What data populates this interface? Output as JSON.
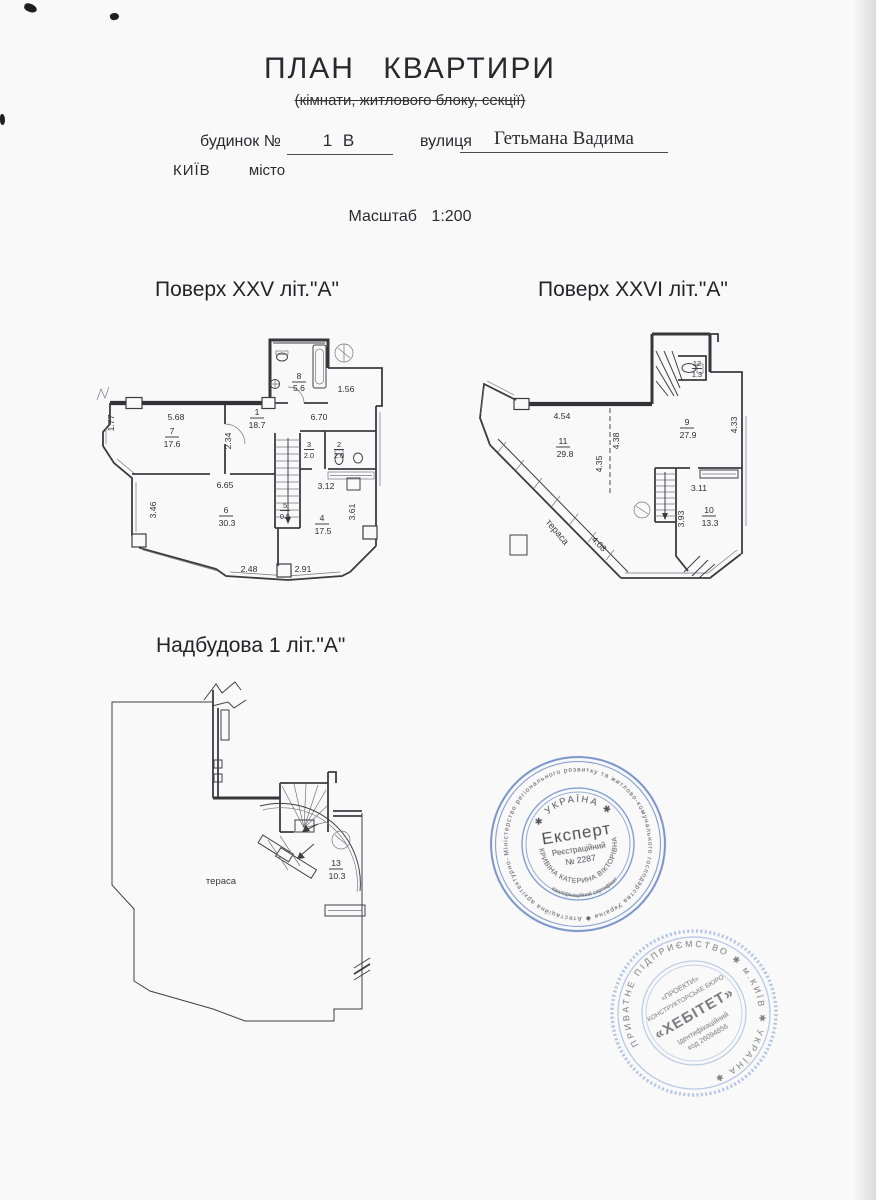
{
  "header": {
    "title": "ПЛАН КВАРТИРИ",
    "subtitle": "(кімнати, житлового блоку, секції)",
    "building_label": "будинок №",
    "building_number": "1 В",
    "street_label": "вулиця",
    "street_name": "Гетьмана Вадима",
    "city_name": "КИЇВ",
    "city_label": "місто",
    "scale_label": "Масштаб",
    "scale_value": "1:200"
  },
  "plan_xxv": {
    "title": "Поверх XXV літ.\"А\"",
    "rooms": {
      "r1": {
        "num": "1",
        "area": "18.7"
      },
      "r2": {
        "num": "2",
        "area": "2.0"
      },
      "r3": {
        "num": "3",
        "area": "2.0"
      },
      "r4": {
        "num": "4",
        "area": "17.5"
      },
      "r5": {
        "num": "5",
        "area": "0.5"
      },
      "r6": {
        "num": "6",
        "area": "30.3"
      },
      "r7": {
        "num": "7",
        "area": "17.6"
      },
      "r8": {
        "num": "8",
        "area": "5.6"
      }
    },
    "dims": {
      "d568": "5.68",
      "d670": "6.70",
      "d177": "1.77",
      "d234": "2.34",
      "d156": "1.56",
      "d665": "6.65",
      "d312": "3.12",
      "d346": "3.46",
      "d361": "3.61",
      "d248": "2.48",
      "d291": "2.91"
    }
  },
  "plan_xxvi": {
    "title": "Поверх XXVI літ.\"А\"",
    "rooms": {
      "r9": {
        "num": "9",
        "area": "27.9"
      },
      "r10": {
        "num": "10",
        "area": "13.3"
      },
      "r11": {
        "num": "11",
        "area": "29.8"
      },
      "r12": {
        "num": "12",
        "area": "1.3"
      }
    },
    "dims": {
      "d454": "4.54",
      "d438": "4.38",
      "d435": "4.35",
      "d433": "4.33",
      "d311": "3.11",
      "d393": "3.93",
      "d408": "4.08"
    },
    "terrace_label": "тераса"
  },
  "plan_nadbudova": {
    "title": "Надбудова 1 літ.\"А\"",
    "rooms": {
      "r13": {
        "num": "13",
        "area": "10.3"
      }
    },
    "terrace_label": "тераса"
  },
  "stamps": {
    "expert": {
      "outer_ring": "Міністерство регіонального розвитку та житлово-комунального господарства України ✱ Атестаційна архітектурно-будівельна комісія ✱",
      "country": "✱ УКРАЇНА ✱",
      "title": "Експерт",
      "reg_label": "Реєстраційний",
      "reg_number": "№ 2287",
      "name_arc": "КРИВІНА КАТЕРИНА ВІКТОРІВНА",
      "cert_arc": "Кваліфікаційний сертифікат",
      "color": "#5d7fc0"
    },
    "habitat": {
      "outer_ring": "ПРИВАТНЕ ПІДПРИЄМСТВО ✱ м.КИЇВ ✱ УКРАЇНА ✱",
      "line1": "«ПРОЕКТИ»",
      "line2": "КОНСТРУКТОРСЬКЕ БЮРО",
      "line3": "«ХЕБІТЕТ»",
      "line4": "Ідентифікаційний",
      "line5": "код 26094856",
      "color": "#87a3d4"
    }
  }
}
